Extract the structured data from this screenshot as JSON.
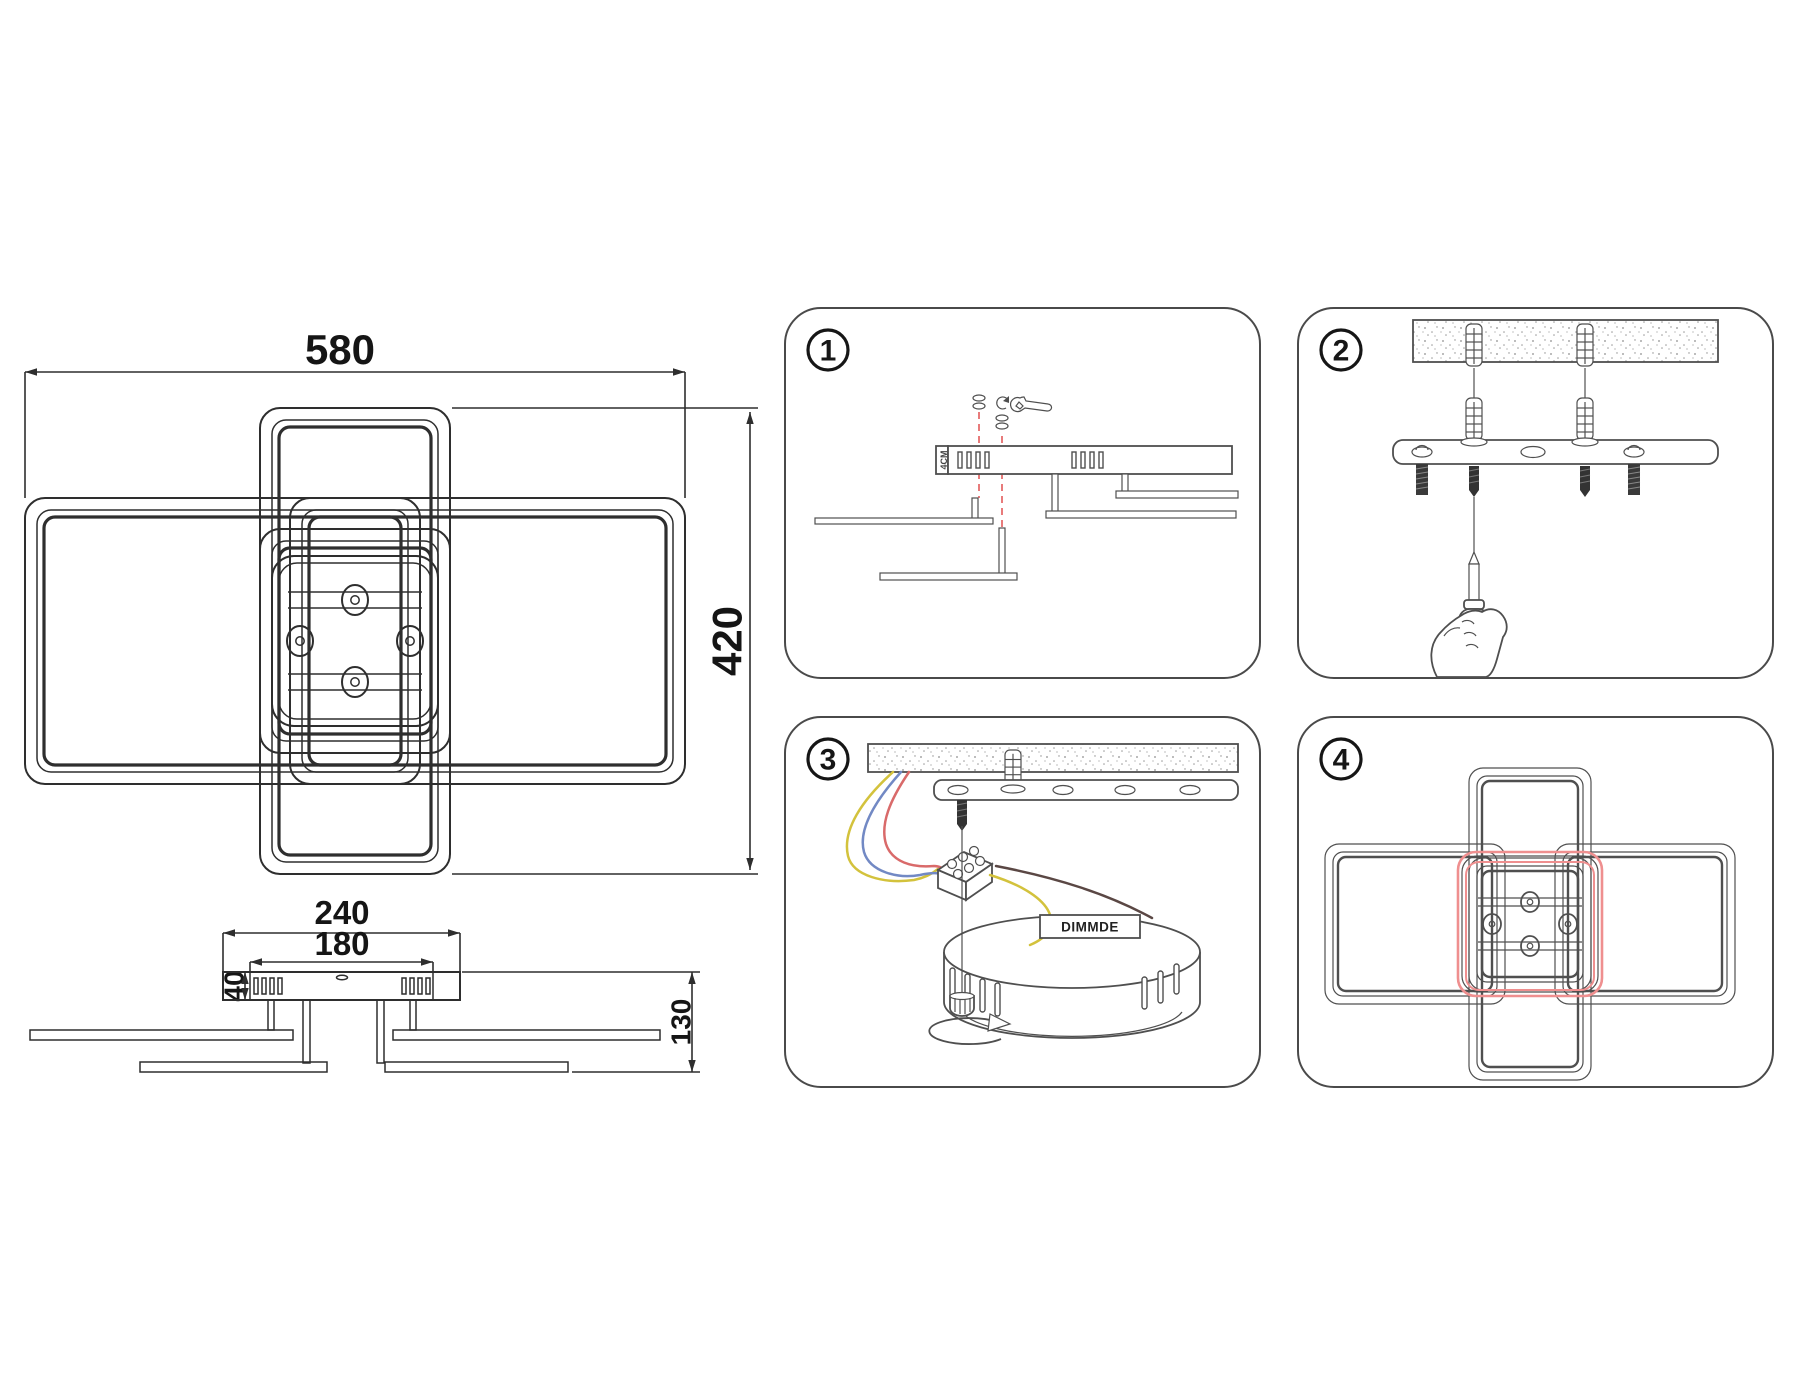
{
  "dimensions": {
    "top_view": {
      "width": "580",
      "height": "420"
    },
    "side_view": {
      "plate_width": "240",
      "box_width": "180",
      "box_height": "40",
      "total_height": "130"
    }
  },
  "steps": [
    {
      "number": "1"
    },
    {
      "number": "2"
    },
    {
      "number": "3"
    },
    {
      "number": "4"
    }
  ],
  "labels": {
    "driver": "DIMMDE",
    "end_cap": "4CM"
  },
  "colors": {
    "line_dark": "#2e2e2e",
    "line_gray": "#4f4f4f",
    "red_dashed": "#e87b7b",
    "red_highlight": "#ef8f8f",
    "wire_yellow": "#d3c23c",
    "wire_blue": "#7289c4",
    "wire_red": "#d96a6a",
    "wire_dark": "#5a4744"
  }
}
